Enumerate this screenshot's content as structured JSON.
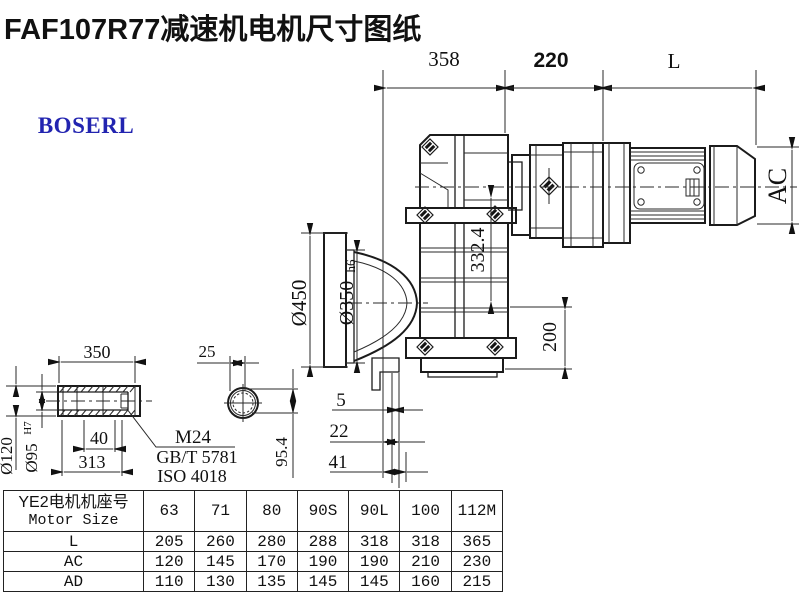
{
  "title": "FAF107R77减速机电机尺寸图纸",
  "logo_text": "BOSERL",
  "dimensions": {
    "housing_depth": "358",
    "adapter_length": "220",
    "motor_length": "L",
    "motor_height": "AC",
    "flange_od": "Ø450",
    "flange_spigot": "Ø350",
    "flange_spigot_tol": "h6",
    "center_height": "332.4",
    "base_height": "200",
    "offset_small": "5",
    "offset_mid": "22",
    "offset_large": "41",
    "shaft_length": "350",
    "bore_step": "40",
    "shaft_inner_length": "313",
    "shaft_od": "Ø120",
    "bore_dia": "Ø95",
    "bore_tol": "H7",
    "key_width": "25",
    "key_height": "95.4"
  },
  "notes": {
    "thread": "M24",
    "standard_gb": "GB/T 5781",
    "standard_iso": "ISO 4018"
  },
  "table": {
    "header_cn": "YE2电机机座号",
    "header_en": "Motor Size",
    "columns": [
      "63",
      "71",
      "80",
      "90S",
      "90L",
      "100",
      "112M"
    ],
    "rows": [
      {
        "label": "L",
        "values": [
          "205",
          "260",
          "280",
          "288",
          "318",
          "318",
          "365"
        ]
      },
      {
        "label": "AC",
        "values": [
          "120",
          "145",
          "170",
          "190",
          "190",
          "210",
          "230"
        ]
      },
      {
        "label": "AD",
        "values": [
          "110",
          "130",
          "135",
          "145",
          "145",
          "160",
          "215"
        ]
      }
    ]
  },
  "colors": {
    "line": "#1b1b1b",
    "logo_text": "#2224b0",
    "logo_border": "#3c2a26",
    "background": "#ffffff"
  }
}
